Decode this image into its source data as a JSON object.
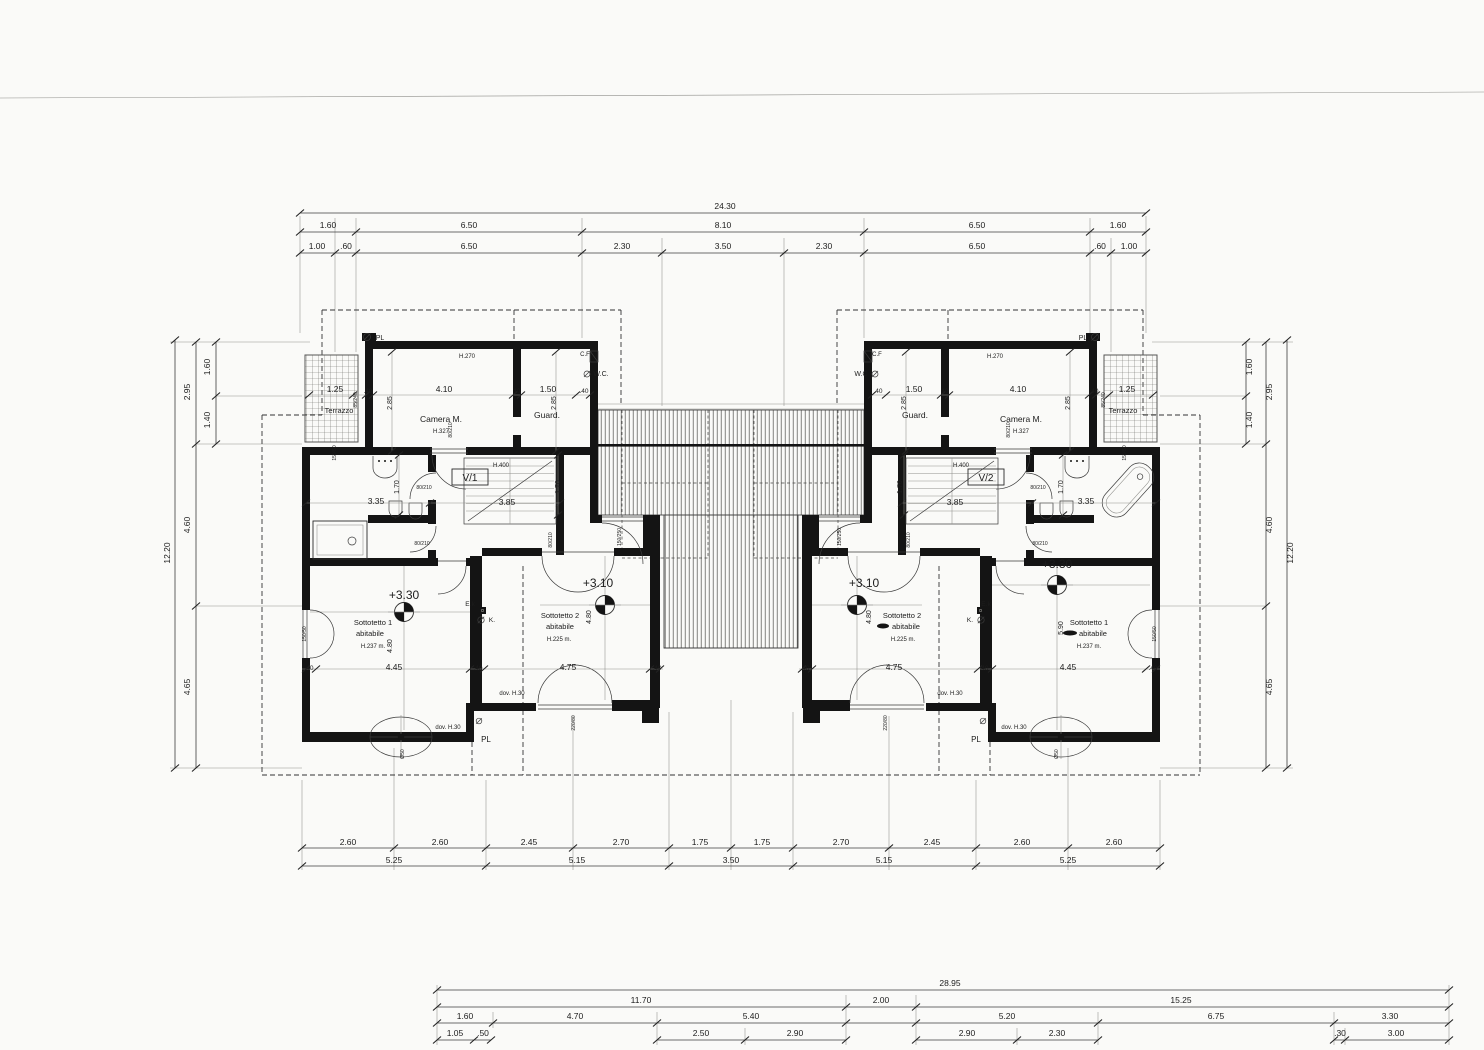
{
  "colors": {
    "paper": "#fafaf8",
    "ink": "#1c1c1c"
  },
  "labels": {
    "dims_top": [
      {
        "n": "dim-total-top",
        "t": "24.30",
        "x": 725,
        "y": 209
      },
      {
        "n": "dim",
        "t": "1.60",
        "x": 328,
        "y": 228
      },
      {
        "n": "dim",
        "t": "6.50",
        "x": 469,
        "y": 228
      },
      {
        "n": "dim",
        "t": "8.10",
        "x": 723,
        "y": 228
      },
      {
        "n": "dim",
        "t": "6.50",
        "x": 977,
        "y": 228
      },
      {
        "n": "dim",
        "t": "1.60",
        "x": 1118,
        "y": 228
      },
      {
        "n": "dim",
        "t": "1.00",
        "x": 317,
        "y": 249
      },
      {
        "n": "dim",
        "t": ".60",
        "x": 346,
        "y": 249
      },
      {
        "n": "dim",
        "t": "6.50",
        "x": 469,
        "y": 249
      },
      {
        "n": "dim",
        "t": "2.30",
        "x": 622,
        "y": 249
      },
      {
        "n": "dim",
        "t": "3.50",
        "x": 723,
        "y": 249
      },
      {
        "n": "dim",
        "t": "2.30",
        "x": 824,
        "y": 249
      },
      {
        "n": "dim",
        "t": "6.50",
        "x": 977,
        "y": 249
      },
      {
        "n": "dim",
        "t": ".60",
        "x": 1100,
        "y": 249
      },
      {
        "n": "dim",
        "t": "1.00",
        "x": 1129,
        "y": 249
      }
    ],
    "dims_left": [
      {
        "n": "dim-total-left",
        "t": "12.20",
        "x": 170,
        "y": 553,
        "r": -90
      },
      {
        "n": "dim",
        "t": "2.95",
        "x": 190,
        "y": 392,
        "r": -90
      },
      {
        "n": "dim",
        "t": "4.60",
        "x": 190,
        "y": 525,
        "r": -90
      },
      {
        "n": "dim",
        "t": "4.65",
        "x": 190,
        "y": 687,
        "r": -90
      },
      {
        "n": "dim",
        "t": "1.60",
        "x": 210,
        "y": 367,
        "r": -90
      },
      {
        "n": "dim",
        "t": "1.40",
        "x": 210,
        "y": 420,
        "r": -90
      }
    ],
    "dims_right": [
      {
        "n": "dim",
        "t": "1.60",
        "x": 1252,
        "y": 367,
        "r": -90
      },
      {
        "n": "dim",
        "t": "1.40",
        "x": 1252,
        "y": 420,
        "r": -90
      },
      {
        "n": "dim",
        "t": "2.95",
        "x": 1272,
        "y": 392,
        "r": -90
      },
      {
        "n": "dim",
        "t": "4.60",
        "x": 1272,
        "y": 525,
        "r": -90
      },
      {
        "n": "dim",
        "t": "4.65",
        "x": 1272,
        "y": 687,
        "r": -90
      },
      {
        "n": "dim-total-right",
        "t": "12.20",
        "x": 1293,
        "y": 553,
        "r": -90
      }
    ],
    "dims_bottom": [
      {
        "n": "dim",
        "t": "2.60",
        "x": 348,
        "y": 845
      },
      {
        "n": "dim",
        "t": "2.60",
        "x": 440,
        "y": 845
      },
      {
        "n": "dim",
        "t": "2.45",
        "x": 529,
        "y": 845
      },
      {
        "n": "dim",
        "t": "2.70",
        "x": 621,
        "y": 845
      },
      {
        "n": "dim",
        "t": "1.75",
        "x": 700,
        "y": 845
      },
      {
        "n": "dim",
        "t": "1.75",
        "x": 762,
        "y": 845
      },
      {
        "n": "dim",
        "t": "2.70",
        "x": 841,
        "y": 845
      },
      {
        "n": "dim",
        "t": "2.45",
        "x": 932,
        "y": 845
      },
      {
        "n": "dim",
        "t": "2.60",
        "x": 1022,
        "y": 845
      },
      {
        "n": "dim",
        "t": "2.60",
        "x": 1114,
        "y": 845
      },
      {
        "n": "dim",
        "t": "5.25",
        "x": 394,
        "y": 863
      },
      {
        "n": "dim",
        "t": "5.15",
        "x": 577,
        "y": 863
      },
      {
        "n": "dim",
        "t": "3.50",
        "x": 731,
        "y": 863
      },
      {
        "n": "dim",
        "t": "5.15",
        "x": 884,
        "y": 863
      },
      {
        "n": "dim",
        "t": "5.25",
        "x": 1068,
        "y": 863
      }
    ],
    "dims_site": [
      {
        "n": "dim-total-site",
        "t": "28.95",
        "x": 950,
        "y": 986
      },
      {
        "n": "dim",
        "t": "11.70",
        "x": 641,
        "y": 1003
      },
      {
        "n": "dim",
        "t": "2.00",
        "x": 881,
        "y": 1003
      },
      {
        "n": "dim",
        "t": "15.25",
        "x": 1181,
        "y": 1003
      },
      {
        "n": "dim",
        "t": "1.60",
        "x": 465,
        "y": 1019
      },
      {
        "n": "dim",
        "t": "4.70",
        "x": 575,
        "y": 1019
      },
      {
        "n": "dim",
        "t": "5.40",
        "x": 751,
        "y": 1019
      },
      {
        "n": "dim",
        "t": "5.20",
        "x": 1007,
        "y": 1019
      },
      {
        "n": "dim",
        "t": "6.75",
        "x": 1216,
        "y": 1019
      },
      {
        "n": "dim",
        "t": "3.30",
        "x": 1390,
        "y": 1019
      },
      {
        "n": "dim",
        "t": "1.05",
        "x": 455,
        "y": 1036
      },
      {
        "n": "dim",
        "t": ".50",
        "x": 483,
        "y": 1036
      },
      {
        "n": "dim",
        "t": "2.50",
        "x": 701,
        "y": 1036
      },
      {
        "n": "dim",
        "t": "2.90",
        "x": 795,
        "y": 1036
      },
      {
        "n": "dim",
        "t": "2.90",
        "x": 967,
        "y": 1036
      },
      {
        "n": "dim",
        "t": "2.30",
        "x": 1057,
        "y": 1036
      },
      {
        "n": "dim",
        "t": ".30",
        "x": 1340,
        "y": 1036
      },
      {
        "n": "dim",
        "t": "3.00",
        "x": 1396,
        "y": 1036
      }
    ],
    "villa_left": [
      {
        "n": "pl-label",
        "t": "PL",
        "x": 380,
        "y": 340,
        "s": 7
      },
      {
        "n": "height-note",
        "t": "H.270",
        "x": 467,
        "y": 358,
        "s": 6
      },
      {
        "n": "dim",
        "t": ".40",
        "x": 368,
        "y": 393,
        "s": 6.5
      },
      {
        "n": "dim",
        "t": "4.10",
        "x": 444,
        "y": 392
      },
      {
        "n": "dim",
        "t": "10",
        "x": 517,
        "y": 393,
        "s": 6
      },
      {
        "n": "dim",
        "t": "1.50",
        "x": 548,
        "y": 392
      },
      {
        "n": "dim",
        "t": ".40",
        "x": 584,
        "y": 393,
        "s": 6.5
      },
      {
        "n": "dim",
        "t": "2.85",
        "x": 392,
        "y": 403,
        "r": -90,
        "s": 7
      },
      {
        "n": "dim",
        "t": "2.85",
        "x": 556,
        "y": 403,
        "r": -90,
        "s": 7
      },
      {
        "n": "room-label",
        "t": "Camera M.",
        "x": 441,
        "y": 422
      },
      {
        "n": "height-note",
        "t": "H.327",
        "x": 441,
        "y": 433,
        "s": 6
      },
      {
        "n": "room-label",
        "t": "Guard.",
        "x": 547,
        "y": 418
      },
      {
        "n": "tag",
        "t": "C.F",
        "x": 585,
        "y": 356,
        "s": 6
      },
      {
        "n": "room-label",
        "t": "W.C.",
        "x": 601,
        "y": 376,
        "s": 7
      },
      {
        "n": "dim",
        "t": "1.25",
        "x": 335,
        "y": 392
      },
      {
        "n": "room-label",
        "t": "Terrazzo",
        "x": 339,
        "y": 413,
        "s": 7.5
      },
      {
        "n": "tag",
        "t": "85/240",
        "x": 357,
        "y": 400,
        "r": -90,
        "s": 5
      },
      {
        "n": "tag",
        "t": "150/50",
        "x": 336,
        "y": 453,
        "r": -90,
        "s": 5
      },
      {
        "n": "tag",
        "t": "150/50",
        "x": 306,
        "y": 634,
        "r": -90,
        "s": 5
      },
      {
        "n": "villa-id",
        "t": "V/1",
        "x": 470,
        "y": 481,
        "s": 10
      },
      {
        "n": "height-note",
        "t": "H.400",
        "x": 501,
        "y": 467,
        "s": 6
      },
      {
        "n": "dim",
        "t": "3.85",
        "x": 507,
        "y": 505
      },
      {
        "n": "dim",
        "t": "1.70",
        "x": 560,
        "y": 487,
        "r": -90,
        "s": 7
      },
      {
        "n": "dim",
        "t": "1.70",
        "x": 399,
        "y": 487,
        "r": -90,
        "s": 7
      },
      {
        "n": "dim",
        "t": "3.35",
        "x": 376,
        "y": 504
      },
      {
        "n": "tag",
        "t": "80/210",
        "x": 452,
        "y": 430,
        "r": -90,
        "s": 5
      },
      {
        "n": "tag",
        "t": "80/210",
        "x": 424,
        "y": 489,
        "s": 5
      },
      {
        "n": "tag",
        "t": "80/210",
        "x": 422,
        "y": 545,
        "s": 5
      },
      {
        "n": "tag",
        "t": "80/210",
        "x": 552,
        "y": 540,
        "r": -90,
        "s": 5
      },
      {
        "n": "tag",
        "t": "150/250",
        "x": 621,
        "y": 537,
        "r": -90,
        "s": 5
      },
      {
        "n": "tag",
        "t": "E.k",
        "x": 470,
        "y": 606,
        "s": 6.5
      },
      {
        "n": "tag",
        "t": "K.",
        "x": 492,
        "y": 622,
        "s": 6.5
      },
      {
        "n": "room-label",
        "t": "Sottotetto 1",
        "x": 373,
        "y": 625,
        "s": 7.5
      },
      {
        "n": "room-label",
        "t": "abitabile",
        "x": 370,
        "y": 636,
        "s": 7.5
      },
      {
        "n": "height-note",
        "t": "H.237 m.",
        "x": 373,
        "y": 648,
        "s": 6
      },
      {
        "n": "level-label",
        "t": "+3.30",
        "x": 404,
        "y": 599,
        "s": 12
      },
      {
        "n": "dim",
        "t": "4.80",
        "x": 392,
        "y": 646,
        "r": -90,
        "s": 7
      },
      {
        "n": "room-label",
        "t": "Sottotetto 2",
        "x": 560,
        "y": 618,
        "s": 7.5
      },
      {
        "n": "room-label",
        "t": "abitabile",
        "x": 560,
        "y": 629,
        "s": 7.5
      },
      {
        "n": "height-note",
        "t": "H.225 m.",
        "x": 559,
        "y": 641,
        "s": 6
      },
      {
        "n": "level-label",
        "t": "+3.10",
        "x": 598,
        "y": 587,
        "s": 12
      },
      {
        "n": "dim",
        "t": "4.80",
        "x": 591,
        "y": 617,
        "r": -90,
        "s": 7
      },
      {
        "n": "dim",
        "t": ".40",
        "x": 309,
        "y": 670,
        "s": 6.5
      },
      {
        "n": "dim",
        "t": "4.45",
        "x": 394,
        "y": 670
      },
      {
        "n": "dim",
        "t": ".40",
        "x": 478,
        "y": 670,
        "s": 6.5
      },
      {
        "n": "dim",
        "t": "4.75",
        "x": 568,
        "y": 670
      },
      {
        "n": "dim",
        "t": ".40",
        "x": 657,
        "y": 670,
        "s": 6.5
      },
      {
        "n": "note",
        "t": "dov. H.30",
        "x": 512,
        "y": 695,
        "s": 6
      },
      {
        "n": "note",
        "t": "dov. H.30",
        "x": 448,
        "y": 729,
        "s": 6
      },
      {
        "n": "pl-label",
        "t": "PL",
        "x": 486,
        "y": 742,
        "s": 8
      },
      {
        "n": "tag",
        "t": "220/80",
        "x": 575,
        "y": 723,
        "r": -90,
        "s": 5
      },
      {
        "n": "tag",
        "t": "Ø50",
        "x": 404,
        "y": 754,
        "r": -90,
        "s": 5
      }
    ],
    "villa_right": [
      {
        "n": "pl-label",
        "t": "PL",
        "x": 1083,
        "y": 340,
        "s": 7
      },
      {
        "n": "height-note",
        "t": "H.270",
        "x": 995,
        "y": 358,
        "s": 6
      },
      {
        "n": "dim",
        "t": ".40",
        "x": 1094,
        "y": 393,
        "s": 6.5
      },
      {
        "n": "dim",
        "t": "4.10",
        "x": 1018,
        "y": 392
      },
      {
        "n": "dim",
        "t": "10",
        "x": 945,
        "y": 393,
        "s": 6
      },
      {
        "n": "dim",
        "t": "1.50",
        "x": 914,
        "y": 392
      },
      {
        "n": "dim",
        "t": ".40",
        "x": 878,
        "y": 393,
        "s": 6.5
      },
      {
        "n": "dim",
        "t": "2.85",
        "x": 1070,
        "y": 403,
        "r": -90,
        "s": 7
      },
      {
        "n": "dim",
        "t": "2.85",
        "x": 906,
        "y": 403,
        "r": -90,
        "s": 7
      },
      {
        "n": "room-label",
        "t": "Camera M.",
        "x": 1021,
        "y": 422
      },
      {
        "n": "height-note",
        "t": "H.327",
        "x": 1021,
        "y": 433,
        "s": 6
      },
      {
        "n": "room-label",
        "t": "Guard.",
        "x": 915,
        "y": 418
      },
      {
        "n": "tag",
        "t": "C.F",
        "x": 877,
        "y": 356,
        "s": 6
      },
      {
        "n": "room-label",
        "t": "W.C",
        "x": 861,
        "y": 376,
        "s": 7
      },
      {
        "n": "dim",
        "t": "1.25",
        "x": 1127,
        "y": 392
      },
      {
        "n": "room-label",
        "t": "Terrazzo",
        "x": 1123,
        "y": 413,
        "s": 7.5
      },
      {
        "n": "tag",
        "t": "85/240",
        "x": 1105,
        "y": 400,
        "r": -90,
        "s": 5
      },
      {
        "n": "tag",
        "t": "150/50",
        "x": 1126,
        "y": 453,
        "r": -90,
        "s": 5
      },
      {
        "n": "tag",
        "t": "150/50",
        "x": 1156,
        "y": 634,
        "r": -90,
        "s": 5
      },
      {
        "n": "villa-id",
        "t": "V/2",
        "x": 986,
        "y": 481,
        "s": 10
      },
      {
        "n": "height-note",
        "t": "H.400",
        "x": 961,
        "y": 467,
        "s": 6
      },
      {
        "n": "dim",
        "t": "3.85",
        "x": 955,
        "y": 505
      },
      {
        "n": "dim",
        "t": "1.70",
        "x": 902,
        "y": 487,
        "r": -90,
        "s": 7
      },
      {
        "n": "dim",
        "t": "1.70",
        "x": 1063,
        "y": 487,
        "r": -90,
        "s": 7
      },
      {
        "n": "dim",
        "t": "3.35",
        "x": 1086,
        "y": 504
      },
      {
        "n": "tag",
        "t": "80/210",
        "x": 1010,
        "y": 430,
        "r": -90,
        "s": 5
      },
      {
        "n": "tag",
        "t": "80/210",
        "x": 1038,
        "y": 489,
        "s": 5
      },
      {
        "n": "tag",
        "t": "80/210",
        "x": 1040,
        "y": 545,
        "s": 5
      },
      {
        "n": "tag",
        "t": "80/210",
        "x": 910,
        "y": 540,
        "r": -90,
        "s": 5
      },
      {
        "n": "tag",
        "t": "150/250",
        "x": 841,
        "y": 537,
        "r": -90,
        "s": 5
      },
      {
        "n": "tag",
        "t": "E.k",
        "x": 986,
        "y": 606,
        "s": 6.5
      },
      {
        "n": "tag",
        "t": "K.",
        "x": 970,
        "y": 622,
        "s": 6.5
      },
      {
        "n": "room-label",
        "t": "Sottotetto 2",
        "x": 902,
        "y": 618,
        "s": 7.5
      },
      {
        "n": "room-label",
        "t": "abitabile",
        "x": 906,
        "y": 629,
        "s": 7.5
      },
      {
        "n": "height-note",
        "t": "H.225 m.",
        "x": 903,
        "y": 641,
        "s": 6
      },
      {
        "n": "level-label",
        "t": "+3.10",
        "x": 864,
        "y": 587,
        "s": 12
      },
      {
        "n": "dim",
        "t": "4.80",
        "x": 871,
        "y": 617,
        "r": -90,
        "s": 7
      },
      {
        "n": "room-label",
        "t": "Sottotetto 1",
        "x": 1089,
        "y": 625,
        "s": 7.5
      },
      {
        "n": "room-label",
        "t": "abitabile",
        "x": 1093,
        "y": 636,
        "s": 7.5
      },
      {
        "n": "height-note",
        "t": "H.237 m.",
        "x": 1089,
        "y": 648,
        "s": 6
      },
      {
        "n": "level-label",
        "t": "+3.30",
        "x": 1057,
        "y": 568,
        "s": 12
      },
      {
        "n": "dim",
        "t": "5.90",
        "x": 1063,
        "y": 628,
        "r": -90,
        "s": 7
      },
      {
        "n": "dim",
        "t": ".40",
        "x": 805,
        "y": 670,
        "s": 6.5
      },
      {
        "n": "dim",
        "t": "4.75",
        "x": 894,
        "y": 670
      },
      {
        "n": "dim",
        "t": ".40",
        "x": 984,
        "y": 670,
        "s": 6.5
      },
      {
        "n": "dim",
        "t": "4.45",
        "x": 1068,
        "y": 670
      },
      {
        "n": "dim",
        "t": ".40",
        "x": 1153,
        "y": 670,
        "s": 6.5
      },
      {
        "n": "note",
        "t": "dov. H.30",
        "x": 950,
        "y": 695,
        "s": 6
      },
      {
        "n": "note",
        "t": "dov. H.30",
        "x": 1014,
        "y": 729,
        "s": 6
      },
      {
        "n": "pl-label",
        "t": "PL",
        "x": 976,
        "y": 742,
        "s": 8
      },
      {
        "n": "tag",
        "t": "220/80",
        "x": 887,
        "y": 723,
        "r": -90,
        "s": 5
      },
      {
        "n": "tag",
        "t": "Ø50",
        "x": 1058,
        "y": 754,
        "r": -90,
        "s": 5
      }
    ]
  }
}
